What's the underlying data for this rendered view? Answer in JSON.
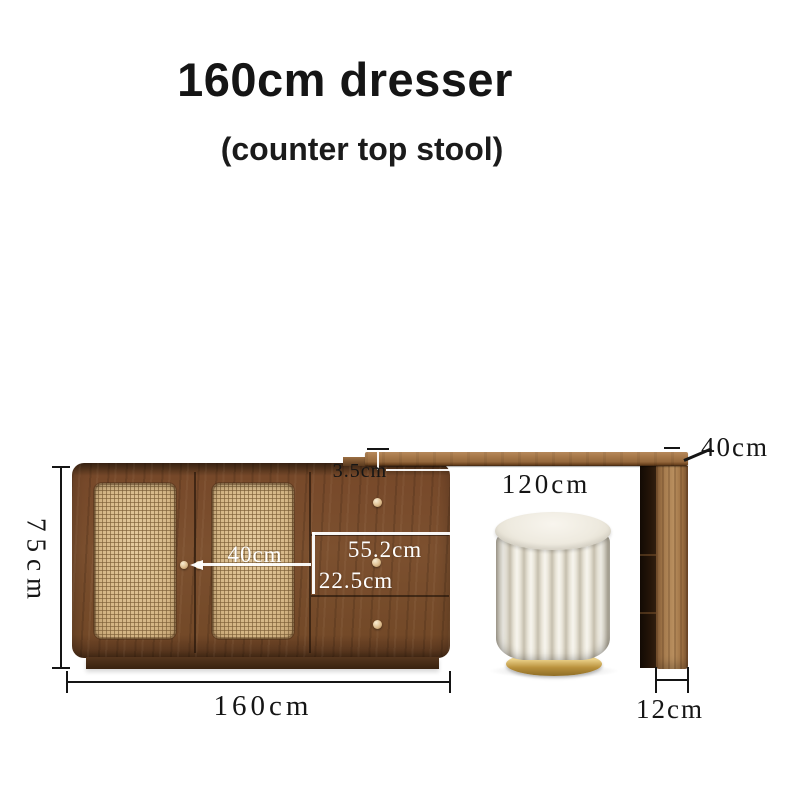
{
  "header": {
    "title": "160cm dresser",
    "subtitle": "(counter top stool)"
  },
  "diagram": {
    "cabinet": {
      "height_label": "75cm",
      "width_label": "160cm",
      "inner_depth_label": "40cm",
      "drawer_width_label": "55.2cm",
      "drawer_height_label": "22.5cm"
    },
    "countertop": {
      "thickness_label": "3.5cm",
      "span_label": "120cm",
      "depth_label": "40cm"
    },
    "leg": {
      "width_label": "12cm"
    },
    "colors": {
      "background": "#ffffff",
      "cabinet_wood": "#7c502f",
      "rattan": "#d8bc8e",
      "countertop_wood": "#a97a4b",
      "leg_wood": "#a97f51",
      "stool_fabric": "#eae6da",
      "stool_base_gold": "#caa24e",
      "dimension_ink": "#151515",
      "annotation_white": "#ffffff"
    }
  }
}
